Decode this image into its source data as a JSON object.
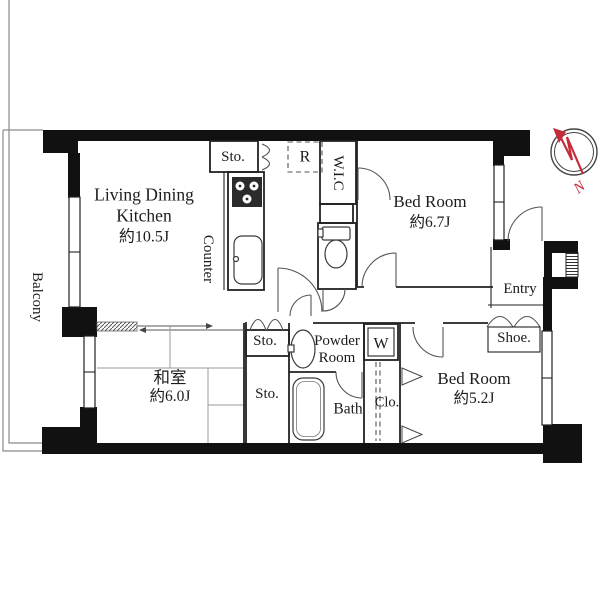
{
  "colors": {
    "background": "#ffffff",
    "wall": "#111111",
    "line": "#222222",
    "stove": "#2b2b2b",
    "compass_red": "#c52b3a"
  },
  "plan": {
    "rooms": {
      "ldk": {
        "name_line1": "Living Dining",
        "name_line2": "Kitchen",
        "size": "約10.5J"
      },
      "bedroom1": {
        "name": "Bed Room",
        "size": "約6.7J"
      },
      "bedroom2": {
        "name": "Bed Room",
        "size": "約5.2J"
      },
      "washitsu": {
        "name": "和室",
        "size": "約6.0J"
      },
      "balcony": {
        "name": "Balcony"
      },
      "entry": {
        "name": "Entry"
      },
      "powder": {
        "name_line1": "Powder",
        "name_line2": "Room"
      },
      "bath": {
        "name": "Bath"
      }
    },
    "labels": {
      "counter": "Counter",
      "wic": "W.I.C",
      "shoe": "Shoe.",
      "closet": "Clo.",
      "storage_kitchen": "Sto.",
      "storage_hall": "Sto.",
      "storage_lower": "Sto.",
      "refrigerator": "R",
      "washer": "W"
    },
    "compass": {
      "north": "N"
    }
  }
}
